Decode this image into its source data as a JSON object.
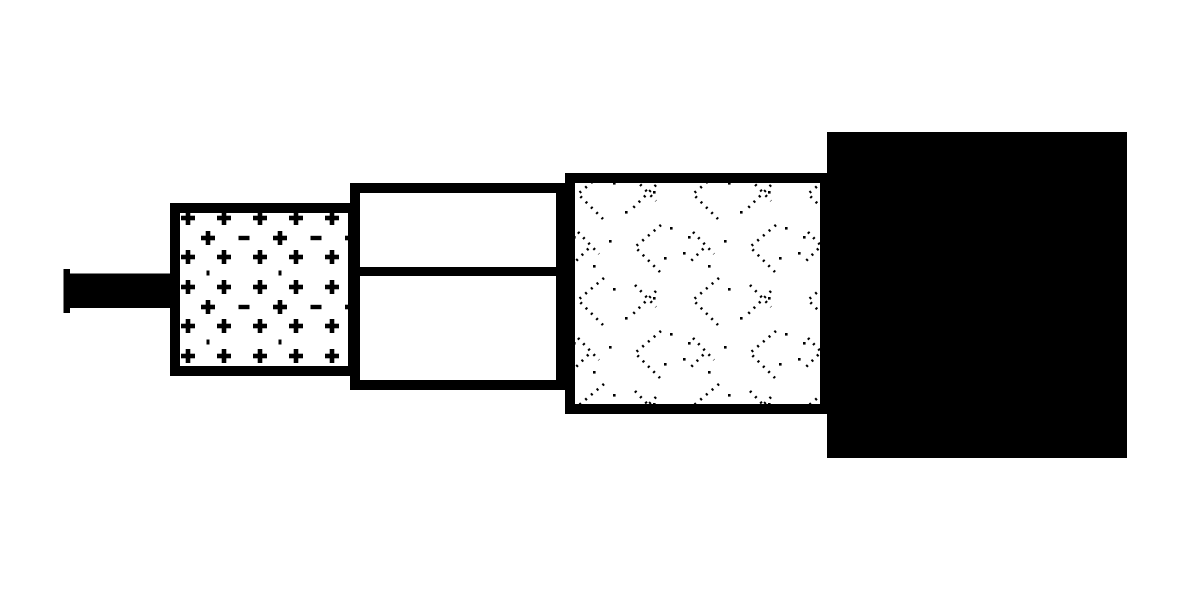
{
  "diagram": {
    "title": "coaxial-cable-construction-diagram",
    "background_color": "#ffffff",
    "ink_color": "#000000",
    "paper_color": "#ffffff",
    "layers": [
      {
        "name": "center-conductor",
        "fill": "solid-black",
        "role": "innermost wire with flat end cap"
      },
      {
        "name": "dielectric-insulation",
        "fill": "plus-minus-dot-pattern",
        "role": "insulator around conductor"
      },
      {
        "name": "foil-shield",
        "fill": "plain-white-two-bands",
        "role": "inner shield split by horizontal divider"
      },
      {
        "name": "braided-shield",
        "fill": "dotted-chevron-braid",
        "role": "woven metallic braid"
      },
      {
        "name": "outer-jacket",
        "fill": "solid-black",
        "role": "outermost sheath"
      }
    ]
  }
}
